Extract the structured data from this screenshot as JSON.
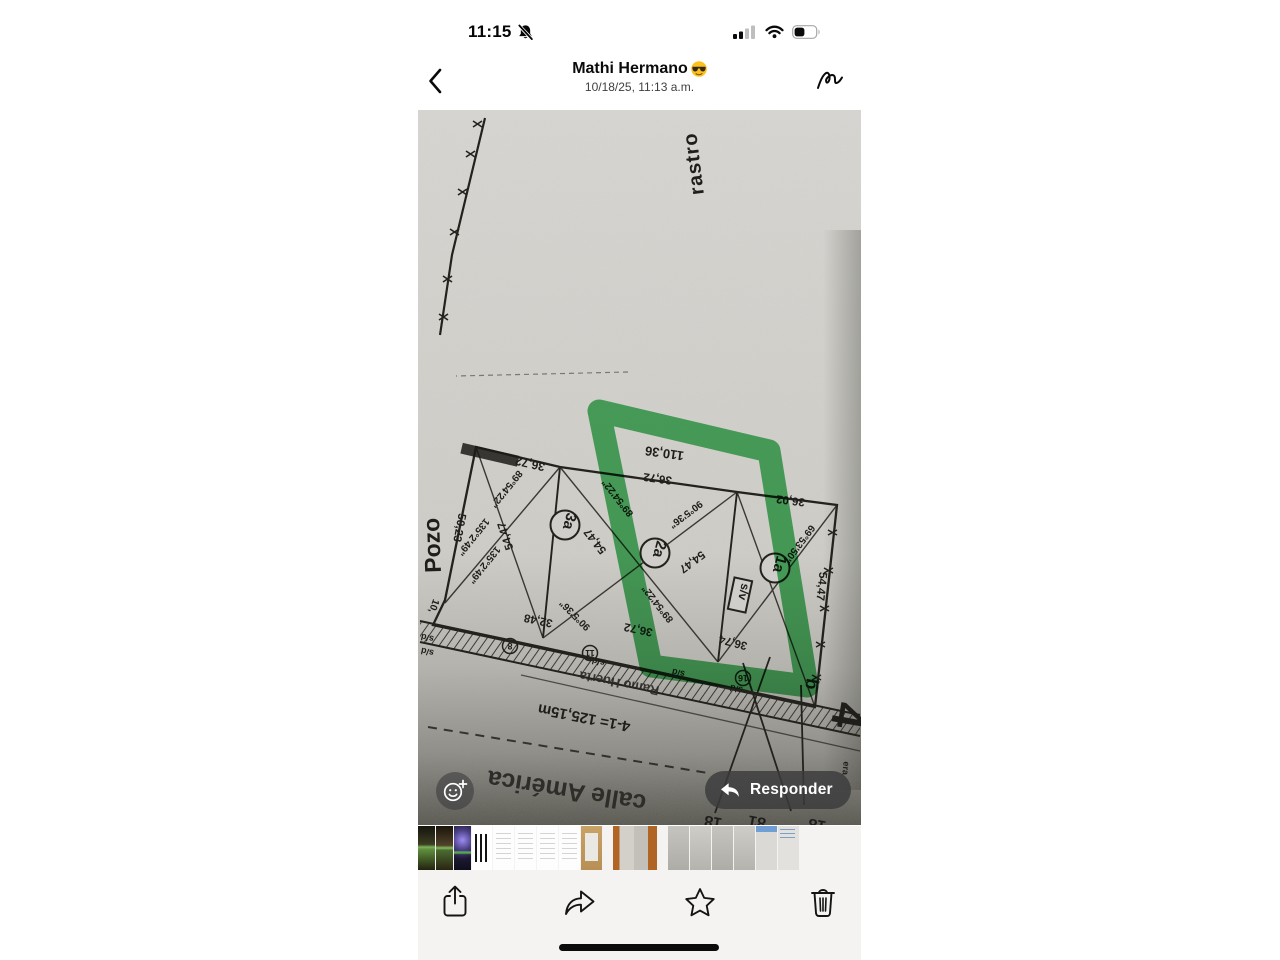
{
  "status_bar": {
    "time": "11:15"
  },
  "header": {
    "title": "Mathi Hermano",
    "subtitle": "10/18/25, 11:13 a.m."
  },
  "photo_overlay": {
    "responder_label": "Responder"
  },
  "icons": {
    "back": "chevron-left-icon",
    "markup": "scribble-markup-icon",
    "muted": "bell-slash-icon",
    "reaction": "add-emoji-reaction-icon",
    "reply": "reply-arrow-icon",
    "share": "share-icon",
    "forward": "forward-arrow-icon",
    "star": "star-icon",
    "trash": "trash-icon"
  },
  "colors": {
    "highlight_green": "#3db457",
    "pill_background": "rgba(58,58,60,0.82)",
    "paper_gray": "#d6d5d1"
  },
  "map": {
    "street_top": "rastro",
    "pozo": "Pozo",
    "street_bottom": "calle América",
    "road": "Ramo Huerta",
    "total": "4-1= 125,15m",
    "corner": "10,",
    "block_big": "4",
    "block_small": "b",
    "side_small": "era",
    "sv": "s/v",
    "lot1": "1a",
    "lot2": "2a",
    "lot3": "3a",
    "len_top3": "36,72",
    "len_top_out": "110,36",
    "len_top2": "36,72",
    "len_top1": "36,02",
    "len_left": "50,23",
    "diag3": "54,47",
    "diag2l": "54,47",
    "diag2r": "54,47",
    "edge1": "54,47",
    "len_bot3": "32,48",
    "len_bot2": "36,72",
    "len_bot1": "36,74",
    "ang3": "89°54'22\"",
    "ang3c1": "135°2'49\"",
    "ang3c2": "135°2'49\"",
    "ang2l": "89°54'22\"",
    "ang2r": "90°5'36\"",
    "ang2bl": "90°5'36\"",
    "ang2br": "89°54'22\"",
    "ang1": "69°53'50\"",
    "sd": "s/d",
    "n8": "8",
    "n11": "11",
    "n16": "16",
    "frag1": "18",
    "frag2": "81",
    "frag3": "18"
  }
}
